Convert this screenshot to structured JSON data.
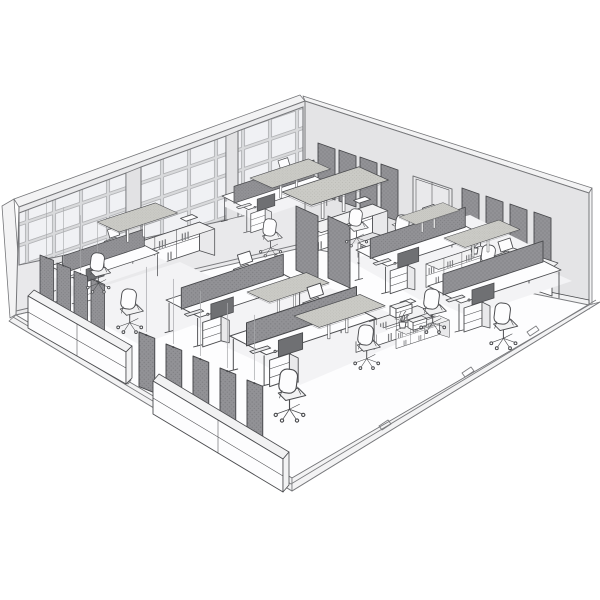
{
  "scene": {
    "title": "Open-plan office interior — monochrome isometric line rendering",
    "style": "architectural sketch, grayscale, no visible text",
    "view": "three-quarter aerial view into a cut-away room"
  },
  "colors": {
    "bg": "#ffffff",
    "line": "#4b4c4f",
    "wall": "#e9e9eb",
    "wall2": "#e4e4e6",
    "wallCap": "#f3f3f4",
    "wallEdge": "#76777a",
    "pillar": "#e2e2e4",
    "pane": "#f0f1f4",
    "paneLine": "#9a9b9e",
    "mullion": "#d9dadc",
    "frame": "#77787b",
    "panelDark": "#929296",
    "panelDot": "#7e7e82",
    "panelEdge": "#46474a",
    "island": "#cbcbc6",
    "islandDot": "#b5b5b0",
    "white": "#fdfdfe",
    "lightFill": "#f2f2f3",
    "midFill": "#e9e9eb",
    "screenDark": "#6f7073",
    "shadow": "#f3f3f5",
    "wire": "#a9aaad",
    "floorLine": "#7b7c7f",
    "binder": "#808184"
  },
  "room": {
    "left_wall": {
      "type": "glazed window wall",
      "window_bays": 3,
      "bay_grid": "4 rows of panes",
      "mullion_pillars": 2
    },
    "right_wall": {
      "type": "solid wall",
      "acoustic_panel_groups": [
        {
          "panels": 4
        },
        {
          "panels": 4
        }
      ],
      "door": {
        "type": "double swing door",
        "leaves": 2
      }
    },
    "floor": {
      "finish": "white",
      "edge": "raised plinth border with outlet tabs",
      "tabs": 5
    }
  },
  "furniture": {
    "suspended_acoustic_islands": 7,
    "desk_clusters": 6,
    "desks": 12,
    "desk_divider_screens": 6,
    "freestanding_screens": 2,
    "task_chairs": 10,
    "monitors": 6,
    "laptops": 6,
    "hanging_panel_rows": [
      {
        "panels": 4
      },
      {
        "panels": 5
      }
    ],
    "wall_mounted_panels": 8,
    "shelving_units": 6,
    "sideboards": 3,
    "plants": 2,
    "printers": 2,
    "waste_bins": 1
  }
}
